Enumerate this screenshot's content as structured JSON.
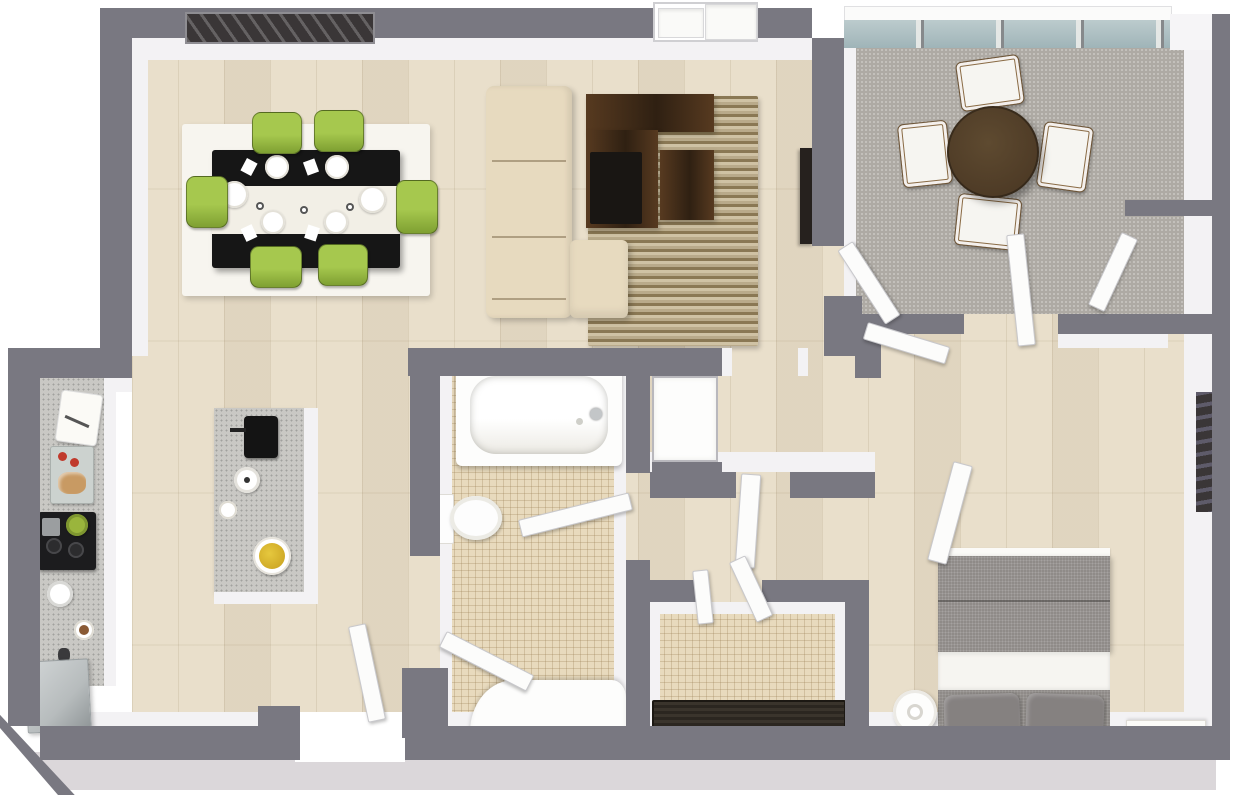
{
  "meta": {
    "description": "3D top-down rendering of a one-bedroom apartment floor plan, no text labels visible",
    "canvas": {
      "width": 1240,
      "height": 795
    }
  },
  "colors": {
    "wall": "#797881",
    "wallFace": "#f3f2f4",
    "plinth": "#dbd7da",
    "wood": "#e9dfcb",
    "tile": "#e8dabd",
    "patio": "#aeaaa4",
    "glass": "#9fb4b8",
    "rugWhite": "#f7f5ef",
    "rugDark": "#8a7854",
    "rugLight": "#cfc2a4",
    "sofa": "#e7dabf",
    "furnWood": "#573a20",
    "furnWoodDark": "#2f2012",
    "screen": "#191613",
    "tableBlack": "#161616",
    "runner": "#f2efe6",
    "chairGreen": "#a6c84e",
    "chairGreenDark": "#7fa032",
    "counter": "#c9c8c4",
    "steel": "#b7bcbd",
    "cooktop": "#1c1c1e",
    "bedGray": "#8f8b88",
    "pillow": "#858180",
    "sheet": "#f6f5f1",
    "radiator": "#2b2620",
    "door": "#fcfcfb",
    "doorEdge": "#c8c8cc",
    "art": "#3a3637",
    "patioTable": "#4e3b26",
    "fruit": "#e6c83e",
    "tomato": "#c0392b",
    "bowlGreen": "#9ab53c"
  },
  "rooms": [
    {
      "name": "living-dining-room",
      "floor": "light-wood-planks",
      "furniture": [
        "wall-artwork",
        "dining-area-rug",
        "black-dining-table",
        "white-table-runner",
        "dinner-plates",
        "green-dining-chairs",
        "beige-sectional-sofa",
        "chaise-lounge",
        "dark-wood-media-console",
        "tv-screen",
        "striped-area-rug",
        "wall-mounted-tv",
        "window-with-ledges"
      ]
    },
    {
      "name": "balcony-sunroom",
      "floor": "gray-carpet",
      "furniture": [
        "glass-curtain-wall",
        "round-dark-wood-table",
        "white-sling-chairs",
        "storage-niche"
      ]
    },
    {
      "name": "kitchen",
      "floor": "light-wood-planks",
      "furniture": [
        "wall-counter",
        "cutting-board",
        "serving-tray",
        "black-cooktop",
        "green-mixing-bowl",
        "round-sink",
        "dessert-plate",
        "pepper-grinder",
        "stainless-appliance",
        "kitchen-island",
        "coffee-machine",
        "white-kettle",
        "side-plate",
        "fruit-bowl"
      ]
    },
    {
      "name": "bathroom",
      "floor": "beige-mosaic-tile",
      "furniture": [
        "bathtub",
        "toilet",
        "curved-vanity-counter"
      ]
    },
    {
      "name": "laundry-storage-room",
      "floor": "beige-mosaic-tile",
      "furniture": [
        "slatted-radiator-rack"
      ]
    },
    {
      "name": "hallway",
      "floor": "light-wood-planks",
      "furniture": [
        "white-linen-closet",
        "open-doors"
      ]
    },
    {
      "name": "bedroom",
      "floor": "light-wood-planks",
      "furniture": [
        "double-bed-gray-duvet",
        "white-sheet-fold",
        "gray-pillows",
        "round-side-table",
        "white-nightstand",
        "wall-art"
      ]
    },
    {
      "name": "entry",
      "floor": "white-threshold",
      "furniture": [
        "open-entry-door"
      ]
    }
  ],
  "counts": {
    "dining_chairs": 6,
    "dinner_plates": 6,
    "patio_chairs": 4,
    "bed_pillows": 2,
    "open_door_panels": 11,
    "cooktop_burners": 2
  }
}
